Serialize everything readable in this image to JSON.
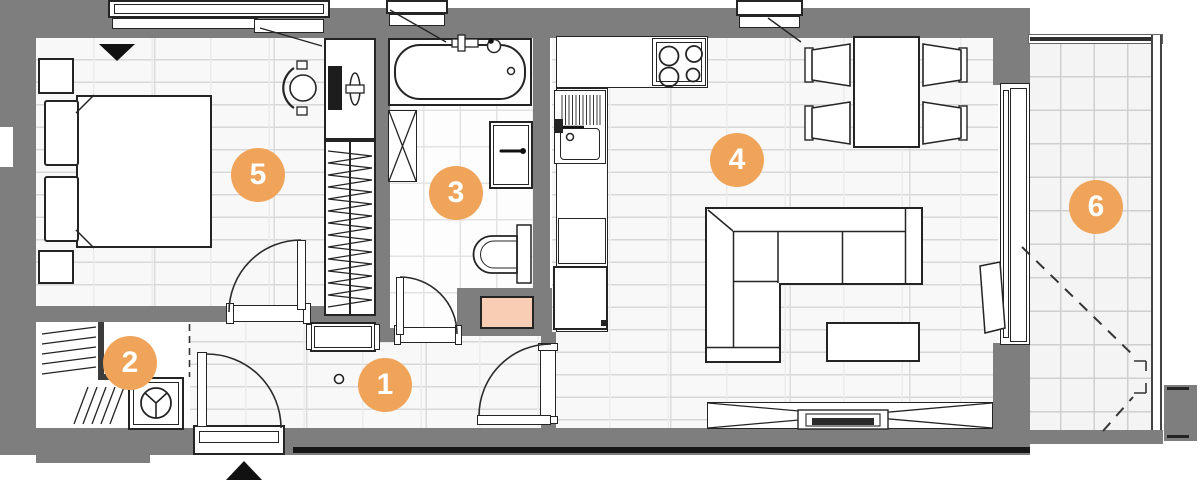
{
  "palette": {
    "wall": "#7e7e7e",
    "badge": "#f0a45a",
    "badge-text": "#ffffff",
    "shaft": "#f9cdb4",
    "line": "#242424",
    "floor": "#f8f8f8"
  },
  "rooms": [
    {
      "id": "hallway",
      "number": "1"
    },
    {
      "id": "storage",
      "number": "2"
    },
    {
      "id": "bathroom",
      "number": "3"
    },
    {
      "id": "living-room-kitchen",
      "number": "4"
    },
    {
      "id": "bedroom",
      "number": "5"
    },
    {
      "id": "balcony",
      "number": "6"
    }
  ]
}
